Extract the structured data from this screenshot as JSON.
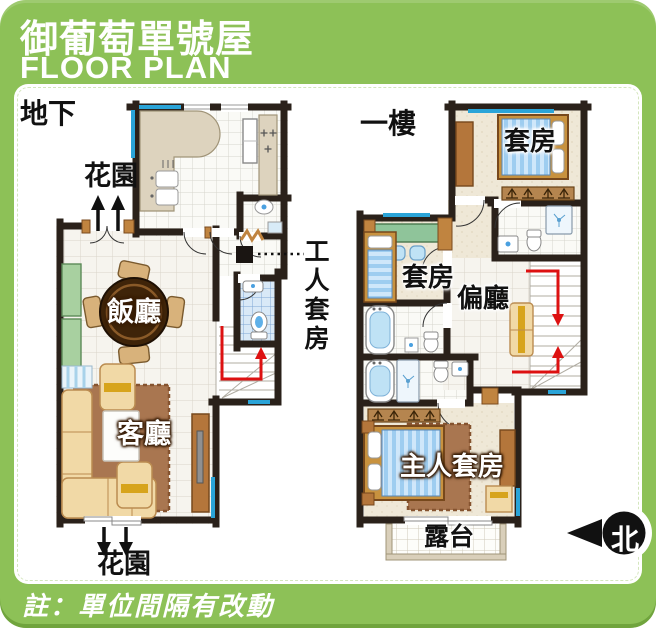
{
  "header": {
    "title": "御葡萄單號屋",
    "subtitle": "FLOOR PLAN"
  },
  "note": "註：單位間隔有改動",
  "compass": {
    "label": "北"
  },
  "ground_floor": {
    "label": "地下",
    "garden_top": "花園",
    "garden_bottom": "花園",
    "dining": "飯廳",
    "living": "客廳",
    "servant_suite": "工人套房"
  },
  "first_floor": {
    "label": "一樓",
    "suite_top": "套房",
    "suite_left": "套房",
    "side_hall": "偏廳",
    "master_suite": "主人套房",
    "terrace": "露台"
  },
  "colors": {
    "card_green": "#8dc157",
    "wall_dark": "#2a211a",
    "window_blue": "#2aa4d8",
    "stair_arrow_red": "#dd1111",
    "wood_brown": "#c08440",
    "counter_beige": "#ddd3be",
    "sofa_tan": "#f1d9a6",
    "rug_brown": "#a97650",
    "cabinet_green": "#a8d0a0",
    "fixture_blue": "#bfe2f5"
  }
}
